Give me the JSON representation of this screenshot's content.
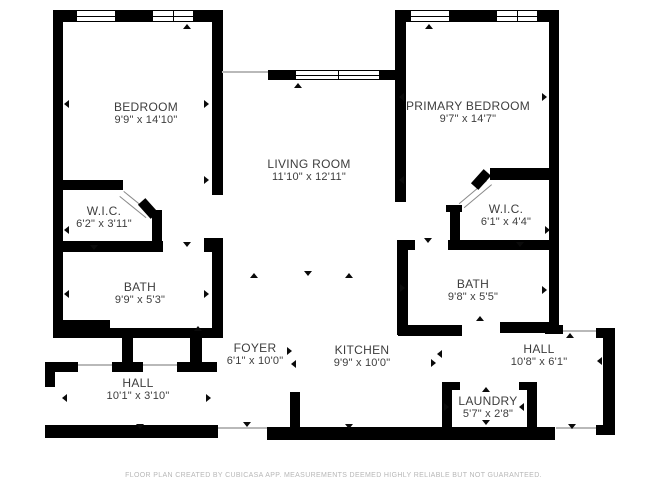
{
  "floor_plan": {
    "rooms": {
      "bedroom": {
        "name": "BEDROOM",
        "dims": "9'9\" x 14'10\""
      },
      "primary_bedroom": {
        "name": "PRIMARY BEDROOM",
        "dims": "9'7\" x 14'7\""
      },
      "living_room": {
        "name": "LIVING ROOM",
        "dims": "11'10\" x 12'11\""
      },
      "wic_left": {
        "name": "W.I.C.",
        "dims": "6'2\" x 3'11\""
      },
      "wic_right": {
        "name": "W.I.C.",
        "dims": "6'1\" x 4'4\""
      },
      "bath_left": {
        "name": "BATH",
        "dims": "9'9\" x 5'3\""
      },
      "bath_right": {
        "name": "BATH",
        "dims": "9'8\" x 5'5\""
      },
      "foyer": {
        "name": "FOYER",
        "dims": "6'1\" x 10'0\""
      },
      "kitchen": {
        "name": "KITCHEN",
        "dims": "9'9\" x 10'0\""
      },
      "hall_right": {
        "name": "HALL",
        "dims": "10'8\" x 6'1\""
      },
      "hall_bottom": {
        "name": "HALL",
        "dims": "10'1\" x 3'10\""
      },
      "laundry": {
        "name": "LAUNDRY",
        "dims": "5'7\" x 2'8\""
      }
    },
    "footer": "FLOOR PLAN CREATED BY CUBICASA APP. MEASUREMENTS DEEMED HIGHLY RELIABLE BUT NOT GUARANTEED.",
    "colors": {
      "wall": "#000000",
      "floor": "#ffffff",
      "label_text": "#3d3d3d",
      "footer_text": "#b7b7b7"
    },
    "icons": {
      "opening_marker": "small black triangle",
      "window": "double-pane window bar",
      "door_swing": "thin diagonal door lines"
    }
  }
}
